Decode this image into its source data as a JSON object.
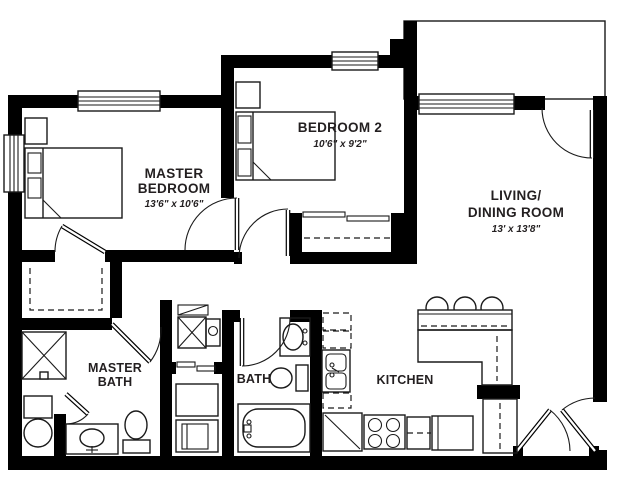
{
  "floor_plan": {
    "rooms": {
      "master_bedroom": {
        "line1": "MASTER",
        "line2": "BEDROOM",
        "dims": "13'6\" x 10'6\""
      },
      "bedroom2": {
        "name": "BEDROOM 2",
        "dims": "10'6\" x 9'2\""
      },
      "living_dining": {
        "line1": "LIVING/",
        "line2": "DINING ROOM",
        "dims": "13' x 13'8\""
      },
      "master_bath": {
        "line1": "MASTER",
        "line2": "BATH"
      },
      "bath": {
        "name": "BATH"
      },
      "kitchen": {
        "name": "KITCHEN"
      }
    },
    "colors": {
      "wall": "#000000",
      "background": "#ffffff",
      "line": "#1a1a1a"
    }
  }
}
